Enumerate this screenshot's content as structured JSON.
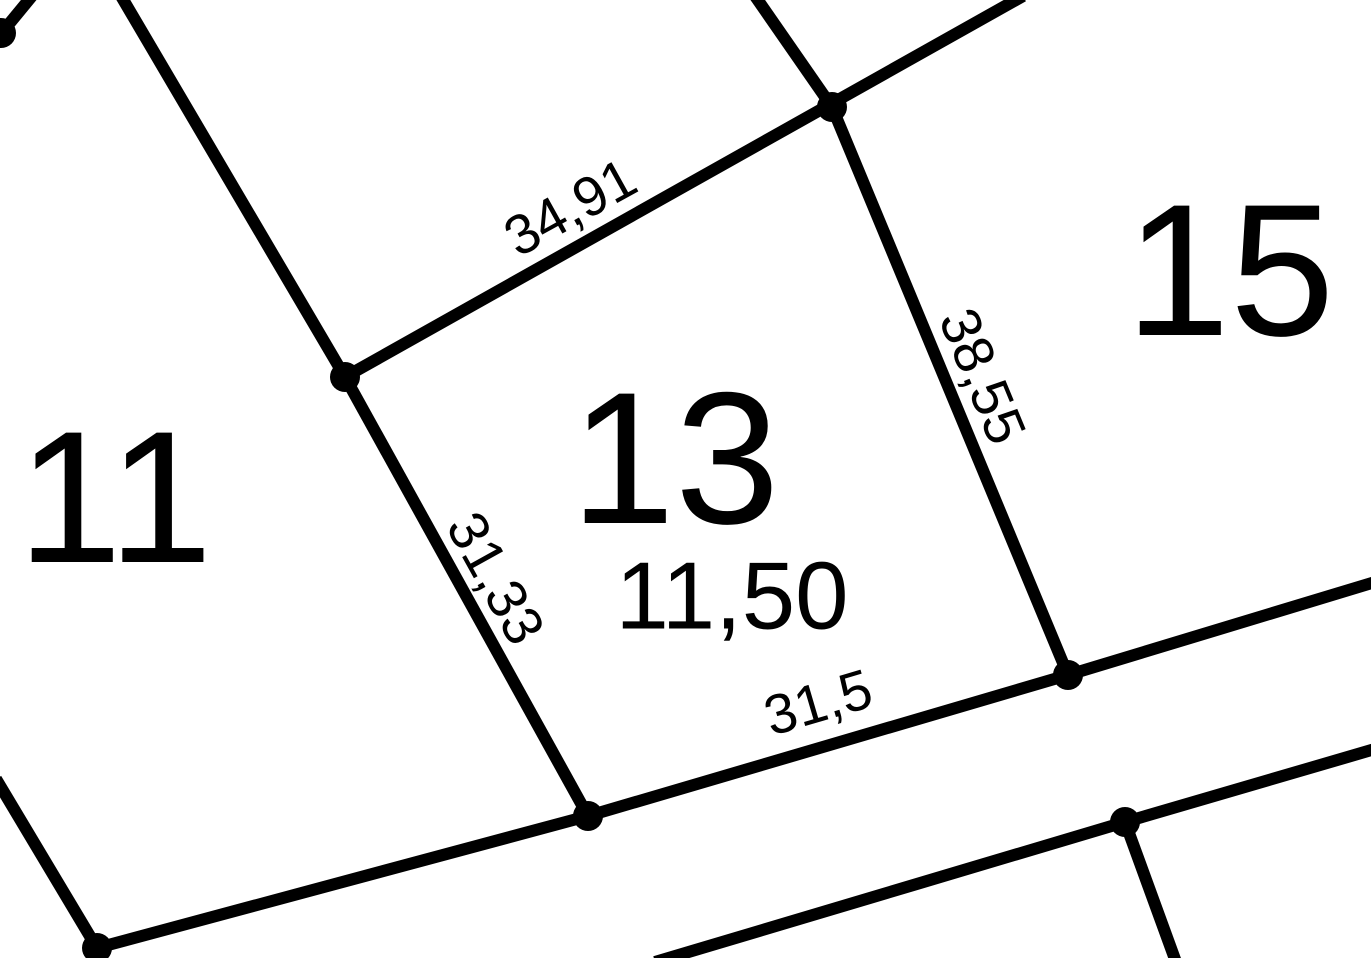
{
  "map": {
    "background_color": "#ffffff",
    "line_color": "#000000",
    "parcels": [
      {
        "number": "11"
      },
      {
        "number": "13",
        "area_label": "11,50"
      },
      {
        "number": "15"
      }
    ],
    "dimensions": [
      {
        "value": "34,91",
        "position": "northwest-edge-of-parcel-13"
      },
      {
        "value": "38,55",
        "position": "east-edge-of-parcel-13"
      },
      {
        "value": "31,33",
        "position": "west-edge-of-parcel-13"
      },
      {
        "value": "31,5",
        "position": "south-edge-of-parcel-13"
      }
    ]
  }
}
